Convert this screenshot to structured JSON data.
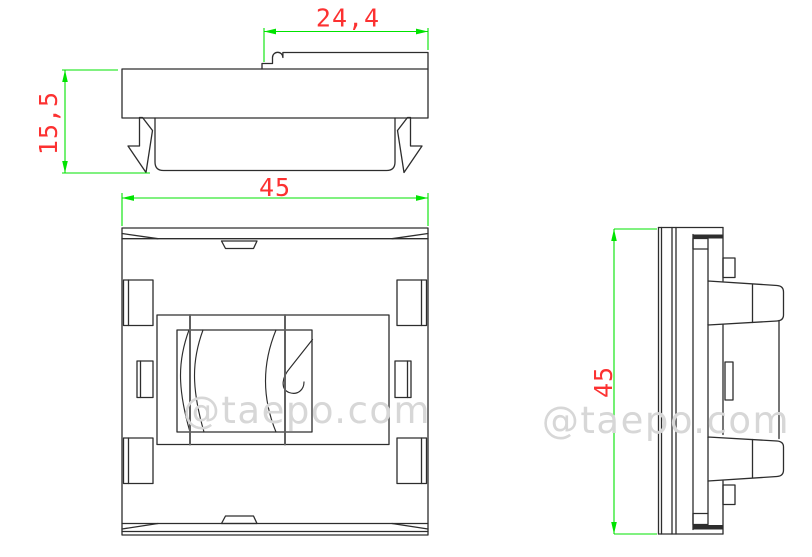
{
  "drawing": {
    "type": "technical-drawing",
    "subject": "45x45 keystone faceplate - three orthographic views",
    "dimensions": {
      "top_width": "24,4",
      "top_height": "15,5",
      "front_width": "45",
      "side_height": "45"
    },
    "watermark": {
      "text": "@taepo.com"
    },
    "colors": {
      "line": "#2d2d2d",
      "line_soft": "#606060",
      "dimension": "#00e300",
      "dimension_text": "#fc3131",
      "watermark": "#d7d7d7",
      "background": "#ffffff"
    }
  }
}
